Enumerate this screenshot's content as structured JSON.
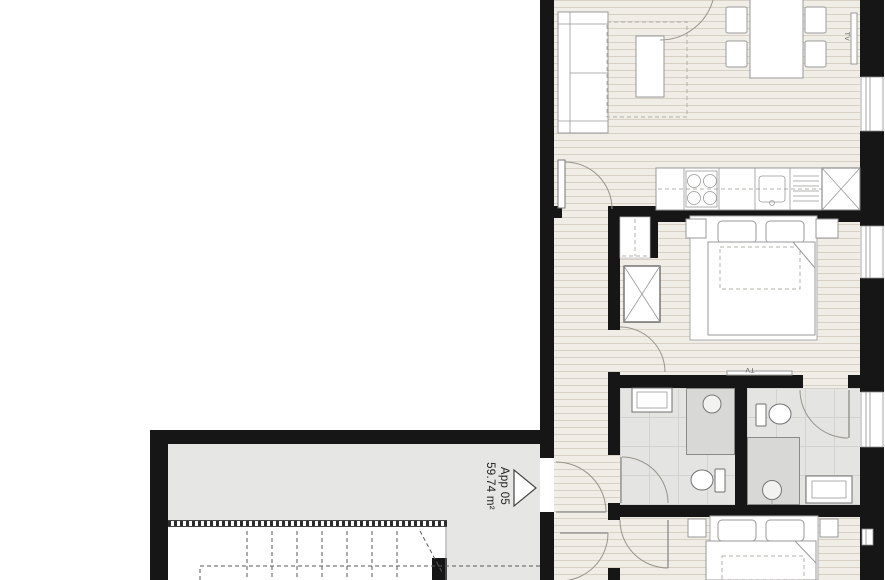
{
  "apartment": {
    "name": "App 05",
    "area": "59.74 m²"
  },
  "labels": {
    "tv_living_room": "TV",
    "tv_bedroom": "TV"
  },
  "colors": {
    "wall": "#161616",
    "wood-floor": "#f0ede6",
    "wood-line": "#ded9cf",
    "tile-floor": "#e4e4e2",
    "tile-line": "#d2d2d0",
    "shower": "#d8d8d6",
    "landing": "#e6e6e4",
    "outline": "#999999",
    "dark-line": "#666666",
    "text": "#222222"
  }
}
